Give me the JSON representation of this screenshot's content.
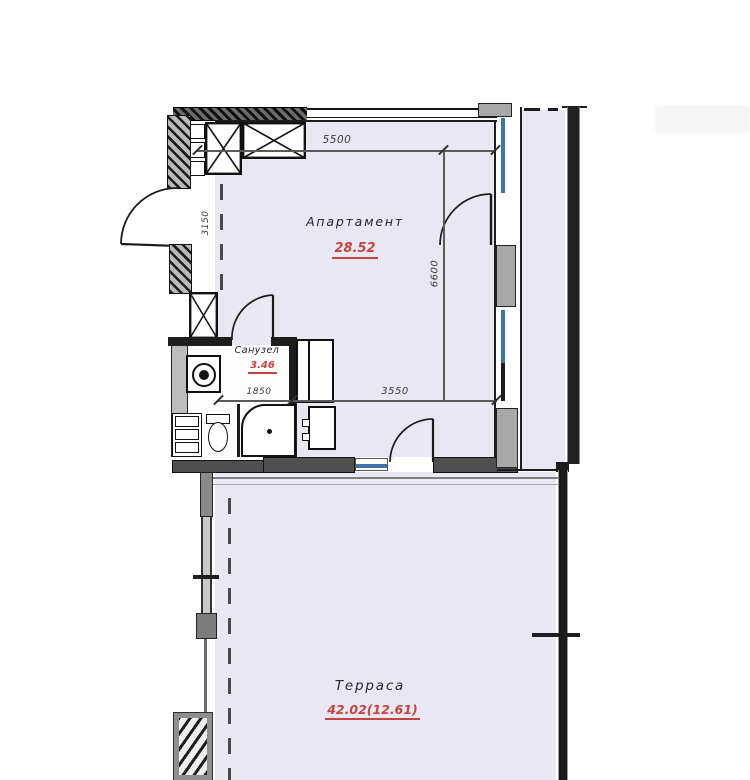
{
  "plan_title": "apartment-floor-plan",
  "rooms": {
    "apartment": {
      "label": "Апартамент",
      "area": "28.52"
    },
    "bathroom": {
      "label": "Санузел",
      "area": "3.46"
    },
    "terrace": {
      "label": "Терраса",
      "area": "42.02(12.61)"
    }
  },
  "dimensions": {
    "top_width": "5500",
    "entry_side": "3150",
    "room_depth": "6600",
    "room_width": "3550",
    "bathroom_width": "1850"
  },
  "colors": {
    "floor_fill": "#eae7f4",
    "wall_dark": "#2a2a2a",
    "wall_gray": "#9a9a9a",
    "glazing_blue": "#3f74ae",
    "area_value_red": "#c4453f",
    "dimension_text": "#3a3a3a"
  },
  "fixtures": {
    "washing_machine": "washing-machine",
    "toilet": "toilet",
    "shower": "shower-cabin",
    "sink": "sink",
    "shaft": "ventilation-shaft"
  }
}
